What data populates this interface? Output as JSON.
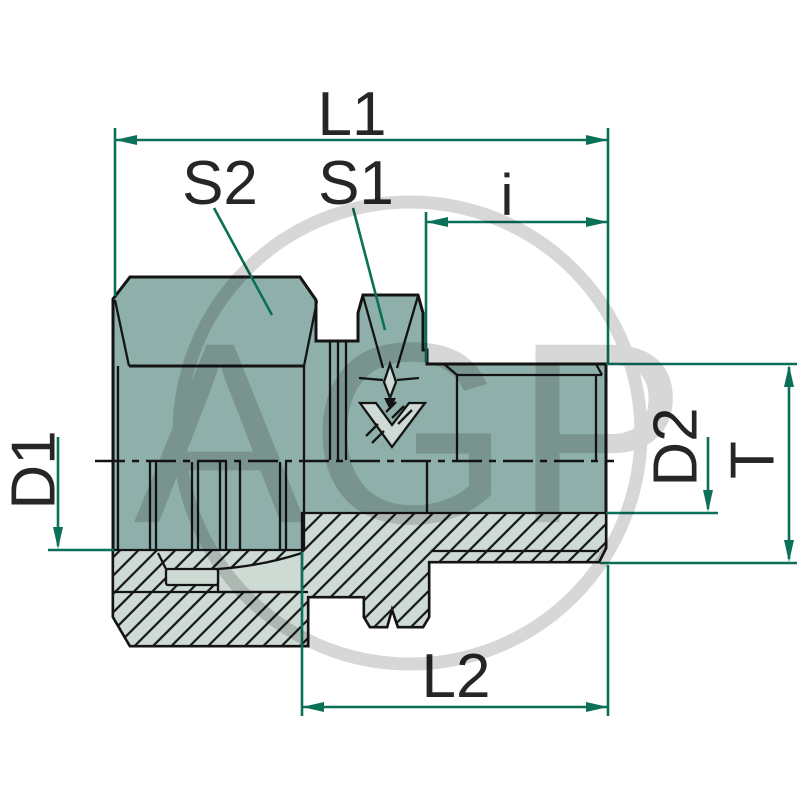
{
  "figure": {
    "type": "technical-drawing",
    "subject": "threaded fitting with compression nut, half-section view"
  },
  "labels": {
    "l1": "L1",
    "s2": "S2",
    "s1": "S1",
    "i": "i",
    "d1": "D1",
    "d2": "D2",
    "t": "T",
    "l2": "L2"
  },
  "watermark": {
    "text": "AGP"
  },
  "colors": {
    "background": "#ffffff",
    "body": "#8fb0aa",
    "section_fill": "#cedad4",
    "outline": "#141414",
    "dimension": "#0a7058",
    "label": "#262626",
    "watermark": "#d7d7d7"
  }
}
